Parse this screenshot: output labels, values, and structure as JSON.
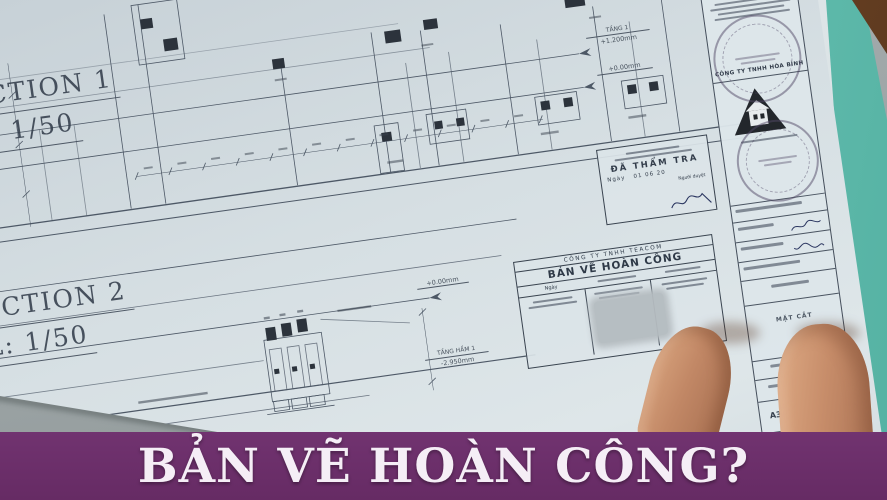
{
  "banner": {
    "text": "BẢN VẼ HOÀN CÔNG?",
    "bg": "#6b2e68",
    "fg": "#f5eef6"
  },
  "sections": {
    "s1_title": "SECTION 1",
    "s1_scale": "TL: 1/50",
    "s2_title": "SECTION 2",
    "s2_scale": "TL: 1/50"
  },
  "levels": {
    "tang1_name": "TẦNG 1",
    "tang1_value": "+1.200mm",
    "ground1_value": "+0.00mm",
    "ground2_value": "+0.00mm",
    "basement_name": "TẦNG HẦM 1",
    "basement_value": "-2.950mm"
  },
  "check_stamp": {
    "title": "ĐÃ THẨM TRA",
    "date_label": "Ngày",
    "date": "01   06   20",
    "signer_label": "Người duyệt"
  },
  "title_block": {
    "company": "CÔNG TY TNHH TEACOM",
    "title": "BẢN VẼ HOÀN CÔNG",
    "date_label": "Ngày"
  },
  "side_block": {
    "company": "CÔNG TY TNHH HÒA BÌNH",
    "drawing_name": "MẶT CẮT",
    "paper_size": "A3"
  },
  "colors": {
    "paper": "#d6dfe3",
    "ink": "#4d5866",
    "teal_folder": "#74cabc",
    "wood_desk": "#7e5028",
    "table": "#9aa2a3",
    "banner_purple": "#6b2e68"
  }
}
